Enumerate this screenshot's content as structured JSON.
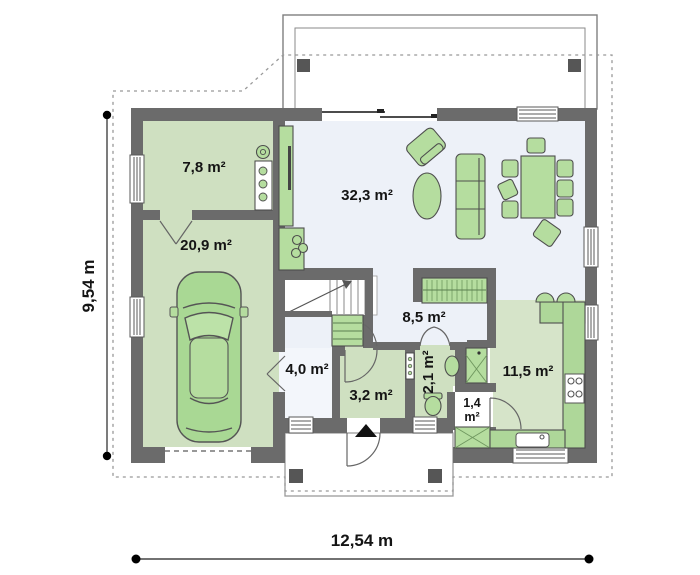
{
  "dimensions": {
    "width": "12,54 m",
    "height": "9,54 m"
  },
  "rooms": [
    {
      "name": "utility-room",
      "area": "7,8 m²"
    },
    {
      "name": "garage",
      "area": "20,9 m²"
    },
    {
      "name": "living-dining-room",
      "area": "32,3 m²"
    },
    {
      "name": "hall",
      "area": "8,5 m²"
    },
    {
      "name": "vestibule",
      "area": "4,0 m²"
    },
    {
      "name": "bathroom",
      "area": "3,2 m²"
    },
    {
      "name": "wc",
      "area": "2,1 m²"
    },
    {
      "name": "kitchen",
      "area": "11,5 m²"
    },
    {
      "name": "pantry",
      "area_line1": "1,4",
      "area_line2": "m²"
    }
  ],
  "colors": {
    "wall": "#6b6b6b",
    "floor_green": "#cfe0c1",
    "floor_light": "#edf1f8",
    "kitchen_floor": "#d6e4c9",
    "furniture_green": "#b5dd9f",
    "counter_green": "#aed799"
  }
}
